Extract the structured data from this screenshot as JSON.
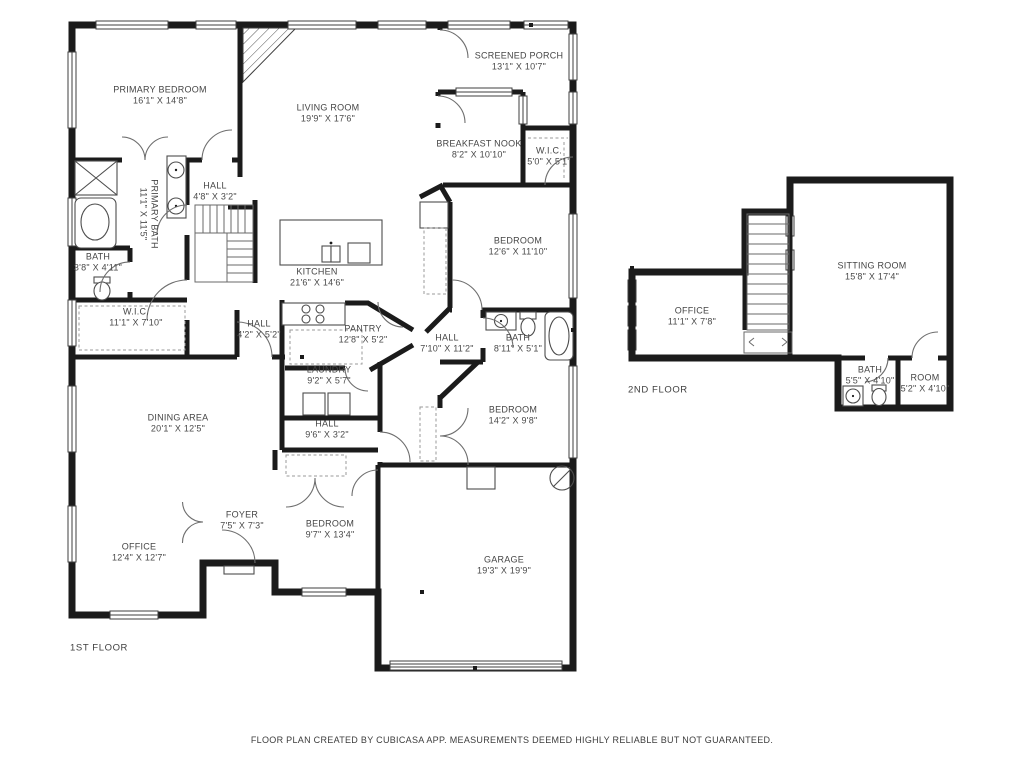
{
  "page": {
    "background": "#ffffff",
    "wall_color": "#1b1b1b",
    "label_color": "#454545"
  },
  "floors": [
    {
      "id": "first",
      "label": "1ST FLOOR"
    },
    {
      "id": "second",
      "label": "2ND FLOOR"
    }
  ],
  "disclaimer": "FLOOR PLAN CREATED BY CUBICASA APP. MEASUREMENTS DEEMED HIGHLY RELIABLE BUT NOT GUARANTEED.",
  "rooms": [
    {
      "floor": "first",
      "name": "PRIMARY BEDROOM",
      "dims": "16'1\" X 14'8\"",
      "x": 160,
      "y": 95,
      "rot": false
    },
    {
      "floor": "first",
      "name": "LIVING ROOM",
      "dims": "19'9\" X 17'6\"",
      "x": 328,
      "y": 113,
      "rot": false
    },
    {
      "floor": "first",
      "name": "SCREENED PORCH",
      "dims": "13'1\" X 10'7\"",
      "x": 519,
      "y": 61,
      "rot": false
    },
    {
      "floor": "first",
      "name": "BREAKFAST NOOK",
      "dims": "8'2\" X 10'10\"",
      "x": 479,
      "y": 149,
      "rot": false
    },
    {
      "floor": "first",
      "name": "W.I.C.",
      "dims": "5'0\" X 5'1\"",
      "x": 549,
      "y": 156,
      "rot": false
    },
    {
      "floor": "first",
      "name": "HALL",
      "dims": "4'8\" X 3'2\"",
      "x": 215,
      "y": 191,
      "rot": false
    },
    {
      "floor": "first",
      "name": "PRIMARY BATH",
      "dims": "11'1\" X 11'5\"",
      "x": 149,
      "y": 214,
      "rot": true
    },
    {
      "floor": "first",
      "name": "BATH",
      "dims": "3'8\" X 4'11\"",
      "x": 98,
      "y": 262,
      "rot": false
    },
    {
      "floor": "first",
      "name": "W.I.C.",
      "dims": "11'1\" X 7'10\"",
      "x": 136,
      "y": 317,
      "rot": false
    },
    {
      "floor": "first",
      "name": "HALL",
      "dims": "4'2\" X 5'2\"",
      "x": 259,
      "y": 329,
      "rot": false
    },
    {
      "floor": "first",
      "name": "KITCHEN",
      "dims": "21'6\" X 14'6\"",
      "x": 317,
      "y": 277,
      "rot": false
    },
    {
      "floor": "first",
      "name": "PANTRY",
      "dims": "12'8\" X 5'2\"",
      "x": 363,
      "y": 334,
      "rot": false
    },
    {
      "floor": "first",
      "name": "LAUNDRY",
      "dims": "9'2\" X 5'7\"",
      "x": 329,
      "y": 375,
      "rot": false
    },
    {
      "floor": "first",
      "name": "HALL",
      "dims": "9'6\" X 3'2\"",
      "x": 327,
      "y": 429,
      "rot": false
    },
    {
      "floor": "first",
      "name": "HALL",
      "dims": "7'10\" X 11'2\"",
      "x": 447,
      "y": 343,
      "rot": false
    },
    {
      "floor": "first",
      "name": "BATH",
      "dims": "8'11\" X 5'1\"",
      "x": 518,
      "y": 343,
      "rot": false
    },
    {
      "floor": "first",
      "name": "BEDROOM",
      "dims": "12'6\" X 11'10\"",
      "x": 518,
      "y": 246,
      "rot": false
    },
    {
      "floor": "first",
      "name": "BEDROOM",
      "dims": "14'2\" X 9'8\"",
      "x": 513,
      "y": 415,
      "rot": false
    },
    {
      "floor": "first",
      "name": "DINING AREA",
      "dims": "20'1\" X 12'5\"",
      "x": 178,
      "y": 423,
      "rot": false
    },
    {
      "floor": "first",
      "name": "OFFICE",
      "dims": "12'4\" X 12'7\"",
      "x": 139,
      "y": 552,
      "rot": false
    },
    {
      "floor": "first",
      "name": "FOYER",
      "dims": "7'5\" X 7'3\"",
      "x": 242,
      "y": 520,
      "rot": false
    },
    {
      "floor": "first",
      "name": "BEDROOM",
      "dims": "9'7\" X 13'4\"",
      "x": 330,
      "y": 529,
      "rot": false
    },
    {
      "floor": "first",
      "name": "GARAGE",
      "dims": "19'3\" X 19'9\"",
      "x": 504,
      "y": 565,
      "rot": false
    },
    {
      "floor": "second",
      "name": "OFFICE",
      "dims": "11'1\" X 7'8\"",
      "x": 692,
      "y": 316,
      "rot": false
    },
    {
      "floor": "second",
      "name": "SITTING ROOM",
      "dims": "15'8\" X 17'4\"",
      "x": 872,
      "y": 271,
      "rot": false
    },
    {
      "floor": "second",
      "name": "BATH",
      "dims": "5'5\" X 4'10\"",
      "x": 870,
      "y": 375,
      "rot": false
    },
    {
      "floor": "second",
      "name": "ROOM",
      "dims": "5'2\" X 4'10\"",
      "x": 925,
      "y": 383,
      "rot": false
    }
  ]
}
